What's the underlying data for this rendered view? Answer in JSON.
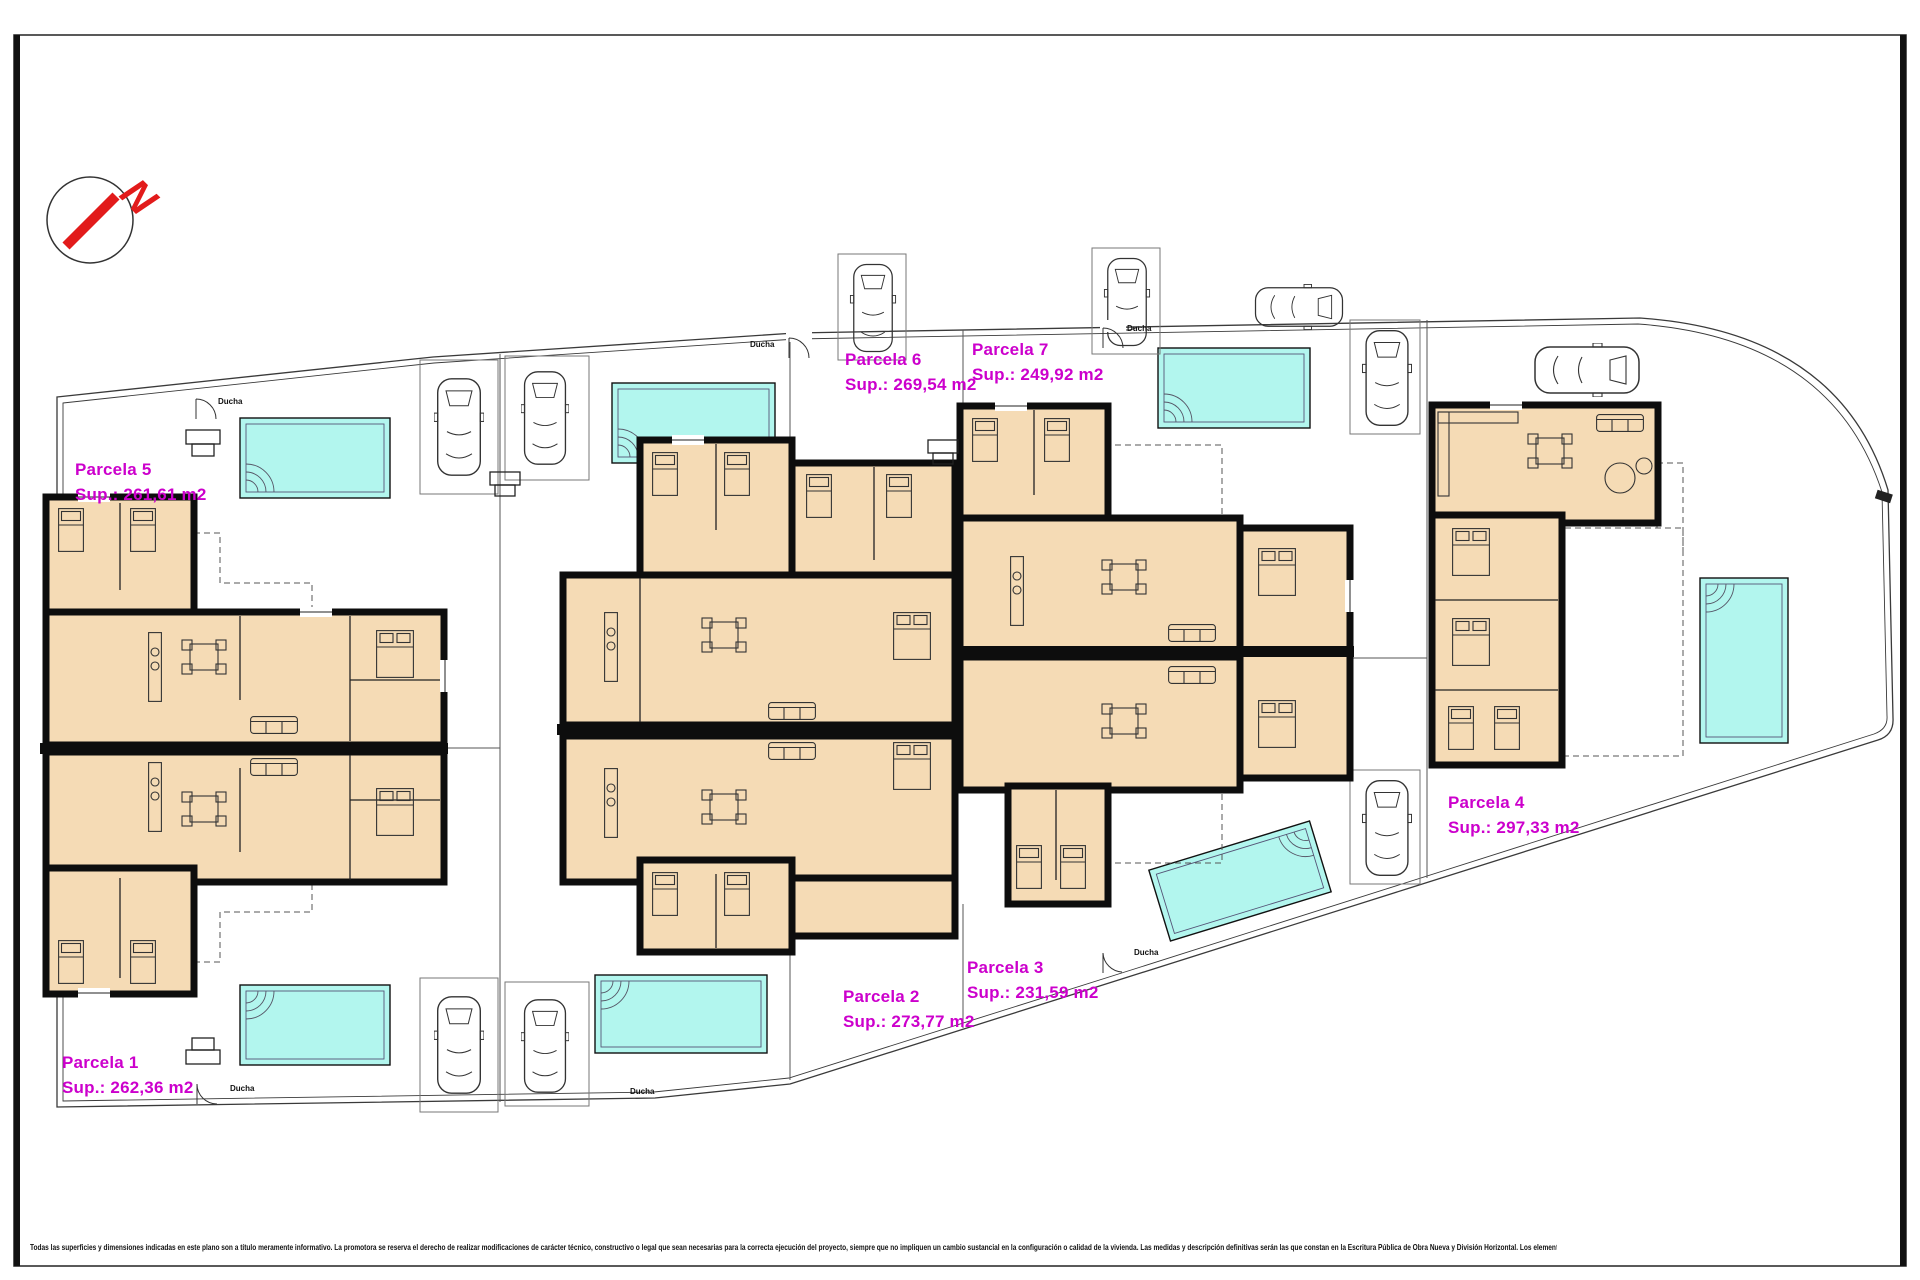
{
  "compass": {
    "letter": "N"
  },
  "parcels": [
    {
      "name": "Parcela 5",
      "sup": "Sup.: 261,61 m2"
    },
    {
      "name": "Parcela 6",
      "sup": "Sup.: 269,54 m2"
    },
    {
      "name": "Parcela 7",
      "sup": "Sup.: 249,92 m2"
    },
    {
      "name": "Parcela 4",
      "sup": "Sup.: 297,33 m2"
    },
    {
      "name": "Parcela 1",
      "sup": "Sup.: 262,36 m2"
    },
    {
      "name": "Parcela 2",
      "sup": "Sup.: 273,77 m2"
    },
    {
      "name": "Parcela 3",
      "sup": "Sup.: 231,59 m2"
    }
  ],
  "annotations": {
    "ducha": "Ducha"
  },
  "disclaimer": "Todas las superficies y dimensiones indicadas en este plano son a título meramente informativo. La promotora se reserva el derecho de realizar modificaciones de carácter técnico, constructivo o legal que sean necesarias para la correcta ejecución del proyecto, siempre que no impliquen un cambio sustancial en la configuración o calidad de la vivienda. Las medidas y descripción definitivas serán las que constan en la Escritura Pública de Obra Nueva y División Horizontal. Los elementos de mobiliario y decoración son ilustrativos y no están incluidos.",
  "colors": {
    "label_magenta": "#CC00CC",
    "floor_tan": "#F5DBB5",
    "pool_cyan": "#B2F6EE",
    "wall_black": "#0d0d0d",
    "north_red": "#E21B1B"
  }
}
